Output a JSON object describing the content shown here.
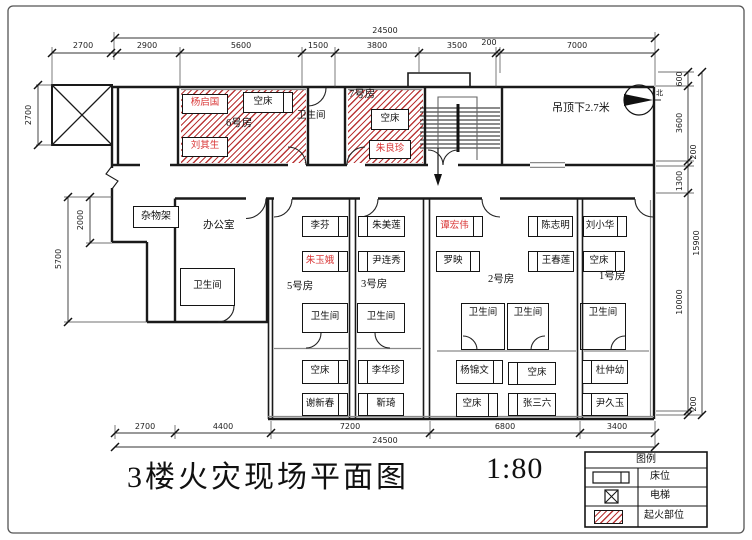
{
  "title": {
    "text": "3楼火灾现场平面图",
    "scale": "1:80"
  },
  "annotations": {
    "ceiling_note": "吊顶下2.7米",
    "north_label": "北"
  },
  "colors": {
    "fire_hatch": "#b62c2c",
    "victim_name": "#d93636",
    "wall": "#1a1a1a"
  },
  "legend": {
    "header": "图例",
    "items": [
      {
        "symbol": "bed-symbol",
        "label": "床位"
      },
      {
        "symbol": "elevator-symbol",
        "label": "电梯"
      },
      {
        "symbol": "fire-origin-symbol",
        "label": "起火部位"
      }
    ]
  },
  "dimensions": {
    "top_left": "2700",
    "top_chain": [
      "2900",
      "5600",
      "1500",
      "3800",
      "3500",
      "200",
      "7000"
    ],
    "top_overall": "24500",
    "left": [
      "2700",
      "2000",
      "5700"
    ],
    "right_chain": [
      "600",
      "3600",
      "200",
      "1300",
      "10000",
      "200"
    ],
    "right_overall": "15900",
    "bottom_chain": [
      "2700",
      "4400",
      "7200",
      "6800",
      "3400"
    ],
    "bottom_overall": "24500"
  },
  "rooms": {
    "room6": {
      "label": "6号房",
      "on_fire": true,
      "beds": [
        {
          "name": "杨启国",
          "red": true
        },
        {
          "name": "空床"
        },
        {
          "name": "刘其生",
          "red": true
        }
      ]
    },
    "bath_top": {
      "label": "卫生间"
    },
    "room7": {
      "label": "7号房",
      "on_fire": true,
      "beds": [
        {
          "name": "空床"
        },
        {
          "name": "朱良珍",
          "red": true
        }
      ]
    },
    "storage": {
      "label": "杂物架"
    },
    "office": {
      "label": "办公室",
      "bath": "卫生间"
    },
    "room5": {
      "label": "5号房",
      "bath": "卫生间",
      "beds": [
        {
          "name": "李芬"
        },
        {
          "name": "朱玉娥",
          "red": true
        },
        {
          "name": "空床"
        },
        {
          "name": "谢新春"
        }
      ]
    },
    "room3": {
      "label": "3号房",
      "bath": "卫生间",
      "beds": [
        {
          "name": "朱美莲"
        },
        {
          "name": "尹连秀"
        },
        {
          "name": "李华珍"
        },
        {
          "name": "靳琦"
        }
      ]
    },
    "room2": {
      "label": "2号房",
      "bath1": "卫生间",
      "bath2": "卫生间",
      "beds": [
        {
          "name": "谭宏伟",
          "red": true
        },
        {
          "name": "罗映"
        },
        {
          "name": "陈志明"
        },
        {
          "name": "王春莲"
        },
        {
          "name": "杨锦文"
        },
        {
          "name": "空床"
        },
        {
          "name": "空床"
        },
        {
          "name": "张三六"
        }
      ]
    },
    "room1": {
      "label": "1号房",
      "bath": "卫生间",
      "beds": [
        {
          "name": "刘小华"
        },
        {
          "name": "空床"
        },
        {
          "name": "杜仲幼"
        },
        {
          "name": "尹久玉"
        }
      ]
    }
  }
}
